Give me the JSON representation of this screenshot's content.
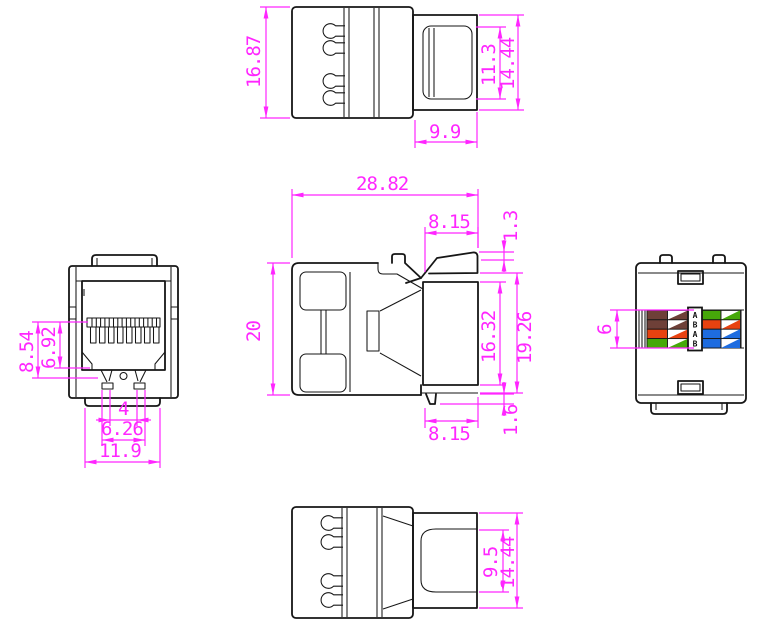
{
  "colors": {
    "dimension": "#ff26ff",
    "outline": "#161616",
    "background": "#ffffff",
    "wire_brown": "#6e4038",
    "wire_orange": "#e84210",
    "wire_green": "#46a80a",
    "wire_blue": "#1e6ce0",
    "wire_white": "#ffffff"
  },
  "views": {
    "top": {
      "dims": {
        "body_height": "16.87",
        "opening_height": "11.3",
        "plug_height": "14.44",
        "plug_length": "9.9"
      }
    },
    "side": {
      "dims": {
        "overall_length": "28.82",
        "latch_top_length": "8.15",
        "lip_height": "1.3",
        "body_height": "20",
        "opening_height": "16.32",
        "plug_overall_height": "19.26",
        "latch_bottom_length": "8.15",
        "foot_height": "1.6"
      }
    },
    "front": {
      "dims": {
        "jack_height": "8.54",
        "contact_height": "6.92",
        "latch_slot_width": "4",
        "latch_width": "6.26",
        "tab_width": "11.9"
      }
    },
    "rear": {
      "dims": {
        "label_height": "6"
      },
      "wiring_label": {
        "letters": [
          "A",
          "B",
          "A",
          "B"
        ],
        "left_rows": [
          "brown",
          "brown",
          "orange",
          "green"
        ],
        "right_rows": [
          "green",
          "orange",
          "blue",
          "blue"
        ]
      }
    },
    "bottom": {
      "dims": {
        "opening_height": "9.5",
        "plug_height": "14.44"
      }
    }
  }
}
